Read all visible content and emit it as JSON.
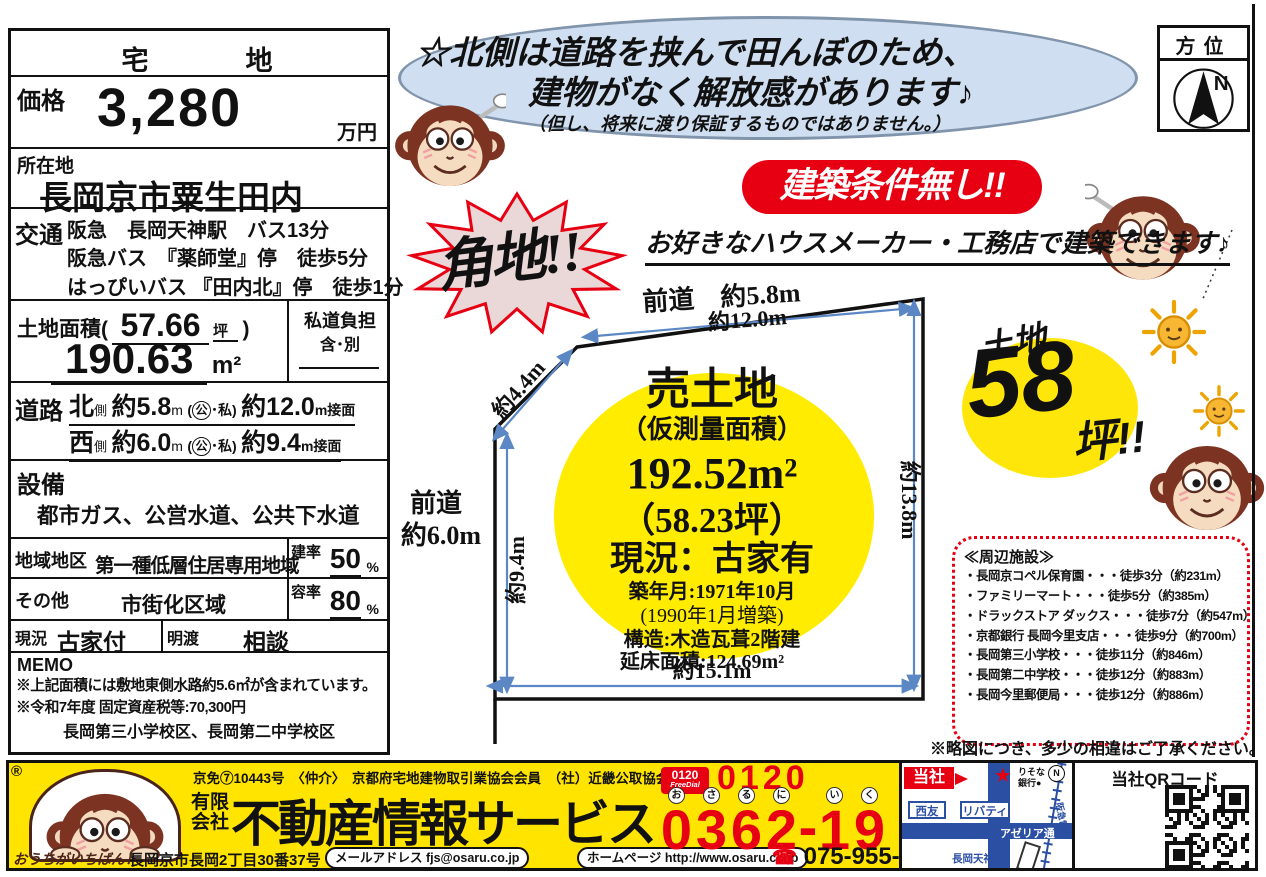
{
  "left_panel": {
    "type_header": "宅　　　地",
    "price": {
      "label": "価格",
      "value": "3,280",
      "unit": "万円"
    },
    "location": {
      "label": "所在地",
      "value": "長岡京市粟生田内"
    },
    "transport": {
      "label": "交通",
      "lines": [
        "阪急　長岡天神駅　バス13分",
        "阪急バス　『薬師堂』停　徒歩5分",
        "はっぴいバス 『田内北』停　徒歩1分"
      ]
    },
    "land_area": {
      "label": "土地面積(",
      "tsubo": "57.66",
      "tsubo_unit": "坪",
      "paren": ")",
      "sqm": "190.63",
      "sqm_unit": "m²"
    },
    "private_road": {
      "label": "私道負担",
      "value": "含･別"
    },
    "road": {
      "label": "道路",
      "rows": [
        {
          "side": "北",
          "side_sub": "側",
          "width": "約5.8",
          "width_unit": "m",
          "kind_open": "(",
          "kind_circled": "公",
          "kind_rest": "･私)",
          "frontage": "約12.0",
          "frontage_unit": "m接面"
        },
        {
          "side": "西",
          "side_sub": "側",
          "width": "約6.0",
          "width_unit": "m",
          "kind_open": "(",
          "kind_circled": "公",
          "kind_rest": "･私)",
          "frontage": "約9.4",
          "frontage_unit": "m接面"
        }
      ]
    },
    "facilities": {
      "label": "設備",
      "value": "都市ガス、公営水道、公共下水道"
    },
    "zoning": {
      "label": "地域地区",
      "value": "第一種低層住居専用地域",
      "ratio_label": "建率",
      "ratio_value": "50",
      "ratio_unit": "%"
    },
    "other": {
      "label": "その他",
      "value": "市街化区域",
      "ratio_label": "容率",
      "ratio_value": "80",
      "ratio_unit": "%"
    },
    "status": {
      "label": "現況",
      "value": "古家付",
      "handover_label": "明渡",
      "handover_value": "相談"
    },
    "memo": {
      "label": "MEMO",
      "lines": [
        "※上記面積には敷地東側水路約5.6㎡が含まれています。",
        "※令和7年度 固定資産税等:70,300円"
      ],
      "school": "長岡第三小学校区、長岡第二中学校区"
    }
  },
  "bubble": {
    "line1": "☆北側は道路を挟んで田んぼのため、",
    "line2": "建物がなく解放感があります♪",
    "note": "（但し、将来に渡り保証するものではありません。）"
  },
  "compass": {
    "title": "方位",
    "north": "N"
  },
  "badges": {
    "corner_lot": "角地!!",
    "no_building_conditions": "建築条件無し!!",
    "builder_free": "お好きなハウスメーカー・工務店で建築できます♪",
    "land_size": {
      "prefix": "土地",
      "number": "58",
      "suffix": "坪!!"
    }
  },
  "plot": {
    "front_road_top": "前道　約5.8m",
    "front_road_left_1": "前道",
    "front_road_left_2": "約6.0m",
    "dim_top": "約12.0m",
    "dim_diagonal": "約4.4m",
    "dim_left": "約9.4m",
    "dim_right": "約13.8m",
    "dim_bottom": "約15.1m",
    "circle": {
      "title": "売土地",
      "subtitle": "（仮測量面積）",
      "area_sqm": "192.52m²",
      "area_tsubo": "（58.23坪）",
      "status": "現況：古家有",
      "built": "築年月:1971年10月",
      "extension": "(1990年1月増築)",
      "structure": "構造:木造瓦葺2階建",
      "floor_area": "延床面積:124.69m²"
    }
  },
  "surroundings": {
    "title": "≪周辺施設≫",
    "items": [
      "・長岡京コペル保育園・・・徒歩3分（約231m）",
      "・ファミリーマート・・・徒歩5分（約385m）",
      "・ドラックストア ダックス・・・徒歩7分（約547m）",
      "・京都銀行 長岡今里支店・・・徒歩9分（約700m）",
      "・長岡第三小学校・・・徒歩11分（約846m）",
      "・長岡第二中学校・・・徒歩12分（約883m）",
      "・長岡今里郵便局・・・徒歩12分（約886m）"
    ],
    "note": "※略図につき、多少の相違はご了承ください。"
  },
  "footer": {
    "registered": "®",
    "license": "京免⑦10443号　〈仲介〉　京都府宅地建物取引業協会会員　（社）近畿公取協会員",
    "company_prefix_1": "有限",
    "company_prefix_2": "会社",
    "company_name": "不動産情報サービス",
    "tagline": "おうちがいちばん！",
    "address": "長岡京市長岡2丁目30番37号",
    "email_pill": "メールアドレス fjs@osaru.co.jp",
    "web_pill": "ホームページ http://www.osaru.co.jp",
    "freedial": {
      "logo_line1": "0120",
      "logo_line2": "FreeDial",
      "prefix": "0120",
      "digits": [
        {
          "d": "0",
          "k": "お"
        },
        {
          "d": "3",
          "k": "さ"
        },
        {
          "d": "6",
          "k": "る"
        },
        {
          "d": "2",
          "k": "に"
        },
        {
          "d": "-",
          "k": ""
        },
        {
          "d": "1",
          "k": "い"
        },
        {
          "d": "9",
          "k": "く"
        }
      ]
    },
    "phone_icon": "☎",
    "phone2": "075-955-6767",
    "map": {
      "company": "当社",
      "star": "★",
      "bank_1": "りそな",
      "bank_2": "銀行●",
      "seiyu": "西友",
      "liberty": "リバティ",
      "street": "アゼリア通",
      "station": "長岡天神駅",
      "railway": "阪急電車",
      "north": "N"
    },
    "qr_label": "当社QRコード"
  }
}
